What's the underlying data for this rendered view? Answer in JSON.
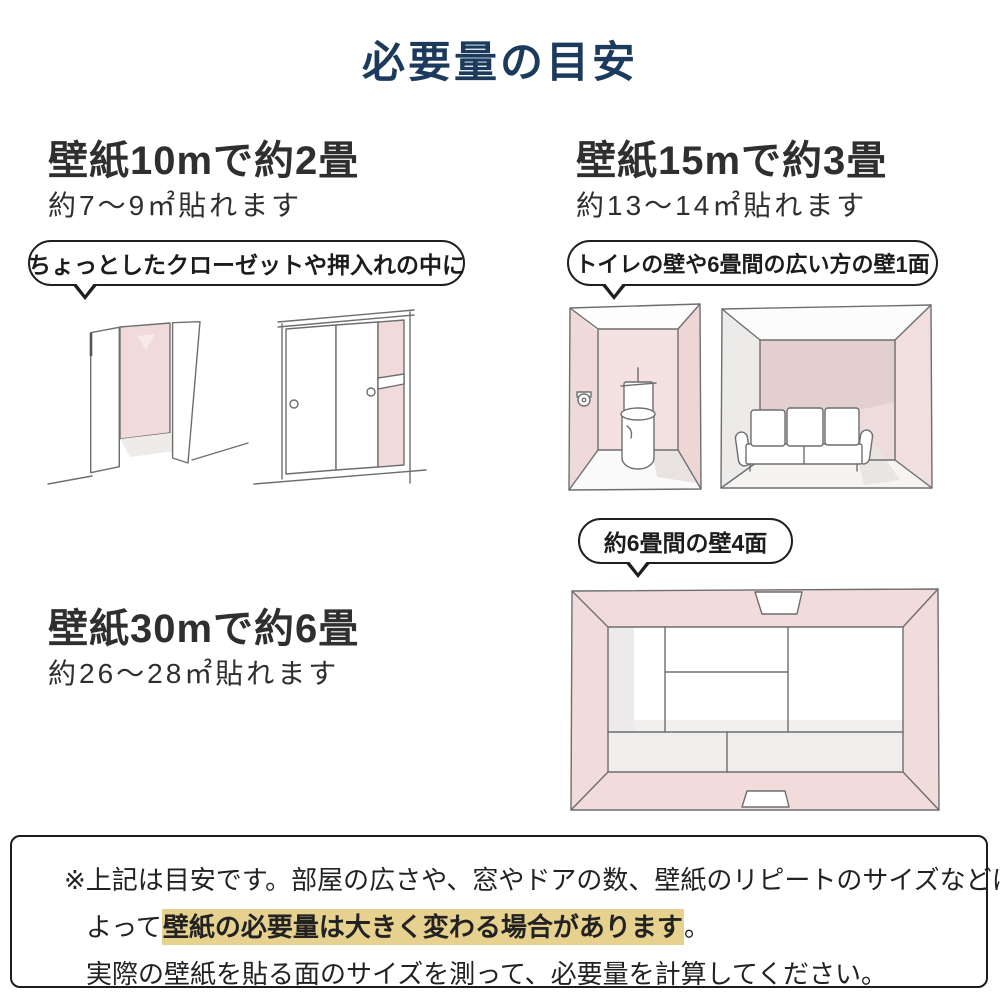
{
  "title": "必要量の目安",
  "blocks": {
    "b10": {
      "heading": "壁紙10mで約2畳",
      "subtext": "約7〜9㎡貼れます",
      "bubble": "ちょっとしたクローゼットや押入れの中に"
    },
    "b15": {
      "heading": "壁紙15mで約3畳",
      "subtext": "約13〜14㎡貼れます",
      "bubble": "トイレの壁や6畳間の広い方の壁1面"
    },
    "b30": {
      "heading": "壁紙30mで約6畳",
      "subtext": "約26〜28㎡貼れます",
      "bubble": "約6畳間の壁4面"
    }
  },
  "note": {
    "line1": "※上記は目安です。部屋の広さや、窓やドアの数、壁紙のリピートのサイズなどに",
    "line2_prefix": "よって",
    "line2_highlight": "壁紙の必要量は大きく変わる場合があります",
    "line2_suffix": "。",
    "line3": "実際の壁紙を貼る面のサイズを測って、必要量を計算してください。"
  },
  "illustrations": {
    "open_closet": "open-closet-sketch",
    "sliding_closet": "sliding-door-closet-sketch",
    "toilet_room": "toilet-room-sketch",
    "sofa_room": "six-mat-room-wall-sketch",
    "tatami_room": "six-mat-room-top-view-sketch"
  },
  "colors": {
    "title_navy": "#1b3a5c",
    "text_dark": "#2f2f2f",
    "wall_pink": "#f0dada",
    "wall_pink_dark": "#e3cfd0",
    "highlight_tan": "#e6d18e",
    "outline_black": "#1f1f1f"
  }
}
